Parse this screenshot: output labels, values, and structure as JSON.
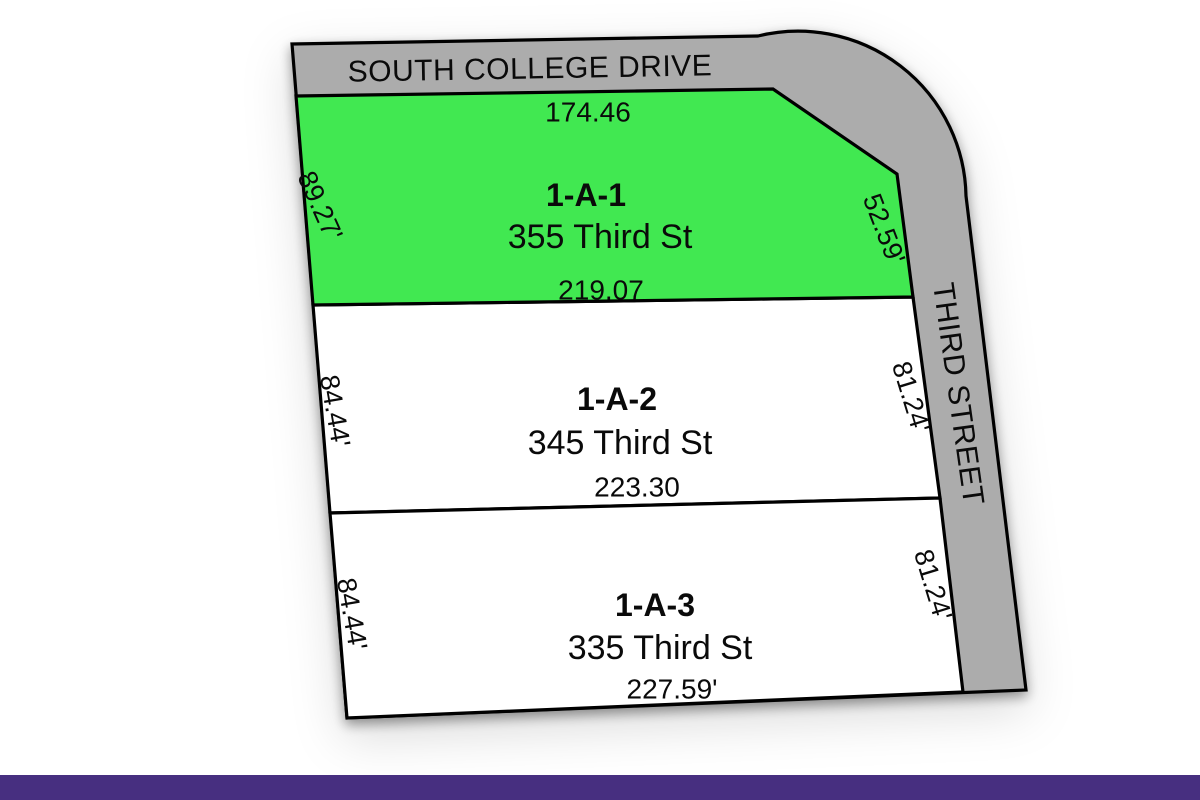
{
  "title": "Subdivision plat map",
  "streets": {
    "top": {
      "name": "SOUTH COLLEGE DRIVE"
    },
    "right": {
      "name": "THIRD STREET"
    }
  },
  "parcels": [
    {
      "id": "1-A-1",
      "address": "355 Third St",
      "highlighted": true,
      "dim_top": "174.46",
      "dim_bottom": "219.07",
      "dim_left": "89.27'",
      "dim_right": "52.59'"
    },
    {
      "id": "1-A-2",
      "address": "345 Third St",
      "highlighted": false,
      "dim_bottom": "223.30",
      "dim_left": "84.44'",
      "dim_right": "81.24'"
    },
    {
      "id": "1-A-3",
      "address": "335 Third St",
      "highlighted": false,
      "dim_bottom": "227.59'",
      "dim_left": "84.44'",
      "dim_right": "81.24'"
    }
  ],
  "colors": {
    "highlight_green": "#41e851",
    "lot_white": "#ffffff",
    "road_gray": "#acacac",
    "boundary_black": "#000000",
    "footer_purple": "#472f80"
  }
}
